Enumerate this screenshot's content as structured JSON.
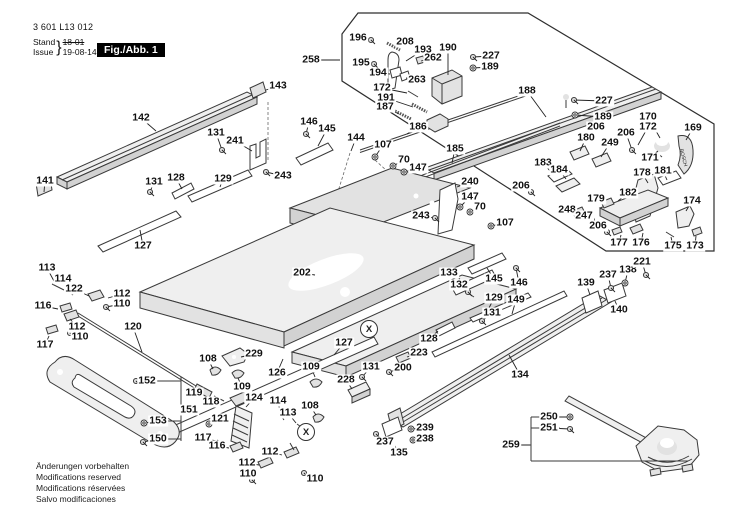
{
  "header": {
    "document_number": "3 601 L13 012",
    "revision_label_de": "Stand",
    "revision_label_en": "Issue",
    "revision_old": "18-01",
    "revision_new": "19-08-14",
    "figure_label": "Fig./Abb. 1"
  },
  "footer": {
    "lines": [
      "Änderungen vorbehalten",
      "Modifications reserved",
      "Modifications réservées",
      "Salvo modificaciones"
    ]
  },
  "diagram": {
    "brand": "BOSCH",
    "connector_symbol": "X",
    "connectors": [
      {
        "x": 369,
        "y": 329
      },
      {
        "x": 306,
        "y": 432
      }
    ],
    "labels": [
      {
        "t": "141",
        "x": 45,
        "y": 181,
        "lx": 44,
        "ly": 192
      },
      {
        "t": "142",
        "x": 141,
        "y": 118,
        "lx": 156,
        "ly": 131
      },
      {
        "t": "143",
        "x": 278,
        "y": 86,
        "lx": 266,
        "ly": 90
      },
      {
        "t": "131",
        "x": 216,
        "y": 133,
        "lx": 222,
        "ly": 150,
        "g": "screw"
      },
      {
        "t": "241",
        "x": 235,
        "y": 141,
        "lx": 252,
        "ly": 151
      },
      {
        "t": "131",
        "x": 154,
        "y": 182,
        "lx": 150,
        "ly": 192,
        "g": "screw"
      },
      {
        "t": "128",
        "x": 176,
        "y": 178,
        "lx": 182,
        "ly": 189
      },
      {
        "t": "129",
        "x": 223,
        "y": 179,
        "lx": 220,
        "ly": 187
      },
      {
        "t": "127",
        "x": 143,
        "y": 246,
        "lx": 140,
        "ly": 230
      },
      {
        "t": "243",
        "x": 283,
        "y": 176,
        "lx": 266,
        "ly": 172,
        "g": "screw"
      },
      {
        "t": "146",
        "x": 309,
        "y": 122,
        "lx": 306,
        "ly": 134,
        "g": "screw"
      },
      {
        "t": "145",
        "x": 327,
        "y": 129,
        "lx": 318,
        "ly": 146
      },
      {
        "t": "144",
        "x": 356,
        "y": 138,
        "lx": 351,
        "ly": 151
      },
      {
        "t": "107",
        "x": 383,
        "y": 145,
        "lx": 375,
        "ly": 157,
        "g": "washer"
      },
      {
        "t": "70",
        "x": 404,
        "y": 160,
        "lx": 393,
        "ly": 166,
        "g": "washer"
      },
      {
        "t": "147",
        "x": 418,
        "y": 168,
        "lx": 404,
        "ly": 172,
        "g": "washer"
      },
      {
        "t": "258",
        "x": 311,
        "y": 60,
        "lx": 340,
        "ly": 60
      },
      {
        "t": "196",
        "x": 358,
        "y": 38,
        "lx": 371,
        "ly": 40,
        "g": "screw"
      },
      {
        "t": "208",
        "x": 405,
        "y": 42,
        "lx": 395,
        "ly": 47
      },
      {
        "t": "193",
        "x": 423,
        "y": 50,
        "lx": 406,
        "ly": 61
      },
      {
        "t": "190",
        "x": 448,
        "y": 48,
        "lx": 448,
        "ly": 75
      },
      {
        "t": "227",
        "x": 491,
        "y": 56,
        "lx": 473,
        "ly": 57,
        "g": "screw"
      },
      {
        "t": "189",
        "x": 490,
        "y": 67,
        "lx": 473,
        "ly": 68,
        "g": "washer"
      },
      {
        "t": "195",
        "x": 361,
        "y": 63,
        "lx": 374,
        "ly": 64,
        "g": "screw"
      },
      {
        "t": "262",
        "x": 433,
        "y": 58,
        "lx": 421,
        "ly": 61
      },
      {
        "t": "194",
        "x": 378,
        "y": 73,
        "lx": 390,
        "ly": 74
      },
      {
        "t": "263",
        "x": 417,
        "y": 80,
        "lx": 406,
        "ly": 78
      },
      {
        "t": "172",
        "x": 382,
        "y": 88,
        "lx": 407,
        "ly": 93
      },
      {
        "t": "191",
        "x": 386,
        "y": 98,
        "lx": 413,
        "ly": 107
      },
      {
        "t": "187",
        "x": 385,
        "y": 107,
        "lx": 399,
        "ly": 114
      },
      {
        "t": "186",
        "x": 418,
        "y": 127,
        "lx": 407,
        "ly": 134
      },
      {
        "t": "188",
        "x": 527,
        "y": 91,
        "lx": 546,
        "ly": 117
      },
      {
        "t": "185",
        "x": 455,
        "y": 149,
        "lx": 452,
        "ly": 163
      },
      {
        "t": "227",
        "x": 604,
        "y": 101,
        "lx": 574,
        "ly": 100,
        "g": "screw"
      },
      {
        "t": "189",
        "x": 603,
        "y": 117,
        "lx": 575,
        "ly": 115,
        "g": "washer"
      },
      {
        "t": "206",
        "x": 596,
        "y": 127,
        "lx": 589,
        "ly": 139,
        "g": "screw"
      },
      {
        "t": "180",
        "x": 586,
        "y": 138,
        "lx": 580,
        "ly": 151
      },
      {
        "t": "249",
        "x": 610,
        "y": 143,
        "lx": 601,
        "ly": 157
      },
      {
        "t": "206",
        "x": 626,
        "y": 133,
        "lx": 632,
        "ly": 150,
        "g": "screw"
      },
      {
        "t": "170",
        "x": 648,
        "y": 117,
        "lx": 660,
        "ly": 138
      },
      {
        "t": "172",
        "x": 648,
        "y": 127,
        "lx": 638,
        "ly": 145
      },
      {
        "t": "169",
        "x": 693,
        "y": 128,
        "lx": 686,
        "ly": 140
      },
      {
        "t": "171",
        "x": 650,
        "y": 158,
        "lx": 658,
        "ly": 151
      },
      {
        "t": "178",
        "x": 642,
        "y": 173,
        "lx": 648,
        "ly": 183
      },
      {
        "t": "181",
        "x": 663,
        "y": 171,
        "lx": 667,
        "ly": 180
      },
      {
        "t": "183",
        "x": 543,
        "y": 163,
        "lx": 551,
        "ly": 172
      },
      {
        "t": "184",
        "x": 559,
        "y": 170,
        "lx": 566,
        "ly": 179
      },
      {
        "t": "182",
        "x": 628,
        "y": 193,
        "lx": 618,
        "ly": 201
      },
      {
        "t": "179",
        "x": 596,
        "y": 199,
        "lx": 605,
        "ly": 204
      },
      {
        "t": "248",
        "x": 567,
        "y": 210,
        "lx": 576,
        "ly": 212
      },
      {
        "t": "247",
        "x": 584,
        "y": 216,
        "lx": 592,
        "ly": 220,
        "g": "screw"
      },
      {
        "t": "206",
        "x": 598,
        "y": 226,
        "lx": 607,
        "ly": 232,
        "g": "screw"
      },
      {
        "t": "174",
        "x": 692,
        "y": 201,
        "lx": 686,
        "ly": 211
      },
      {
        "t": "177",
        "x": 619,
        "y": 243,
        "lx": 621,
        "ly": 235
      },
      {
        "t": "176",
        "x": 641,
        "y": 243,
        "lx": 643,
        "ly": 233
      },
      {
        "t": "175",
        "x": 673,
        "y": 246,
        "lx": 671,
        "ly": 237
      },
      {
        "t": "173",
        "x": 695,
        "y": 246,
        "lx": 696,
        "ly": 236
      },
      {
        "t": "240",
        "x": 470,
        "y": 182,
        "lx": 457,
        "ly": 187
      },
      {
        "t": "206",
        "x": 521,
        "y": 186,
        "lx": 531,
        "ly": 192,
        "g": "screw"
      },
      {
        "t": "147",
        "x": 470,
        "y": 197,
        "lx": 460,
        "ly": 207,
        "g": "washer"
      },
      {
        "t": "70",
        "x": 480,
        "y": 207,
        "lx": 470,
        "ly": 212,
        "g": "washer"
      },
      {
        "t": "243",
        "x": 421,
        "y": 216,
        "lx": 435,
        "ly": 218,
        "g": "screw"
      },
      {
        "t": "107",
        "x": 505,
        "y": 223,
        "lx": 491,
        "ly": 226,
        "g": "washer"
      },
      {
        "t": "202",
        "x": 302,
        "y": 273,
        "lx": 315,
        "ly": 275
      },
      {
        "t": "113",
        "x": 47,
        "y": 268,
        "lx": 55,
        "ly": 283
      },
      {
        "t": "114",
        "x": 63,
        "y": 279,
        "lx": 68,
        "ly": 290
      },
      {
        "t": "122",
        "x": 74,
        "y": 289,
        "lx": 89,
        "ly": 296
      },
      {
        "t": "112",
        "x": 122,
        "y": 294,
        "lx": 108,
        "ly": 298
      },
      {
        "t": "110",
        "x": 122,
        "y": 304,
        "lx": 106,
        "ly": 307,
        "g": "screw"
      },
      {
        "t": "116",
        "x": 43,
        "y": 306,
        "lx": 58,
        "ly": 309
      },
      {
        "t": "112",
        "x": 77,
        "y": 327,
        "lx": 70,
        "ly": 319
      },
      {
        "t": "110",
        "x": 80,
        "y": 337,
        "lx": 70,
        "ly": 333,
        "g": "screw"
      },
      {
        "t": "117",
        "x": 45,
        "y": 345,
        "lx": 49,
        "ly": 336
      },
      {
        "t": "120",
        "x": 133,
        "y": 327,
        "lx": 142,
        "ly": 352
      },
      {
        "t": "152",
        "x": 147,
        "y": 381,
        "lx": 136,
        "ly": 381,
        "g": "screw"
      },
      {
        "t": "151",
        "x": 189,
        "y": 410,
        "lx": 182,
        "ly": 410
      },
      {
        "t": "153",
        "x": 158,
        "y": 421,
        "lx": 144,
        "ly": 423,
        "g": "washer"
      },
      {
        "t": "150",
        "x": 158,
        "y": 439,
        "lx": 143,
        "ly": 442,
        "g": "screw"
      },
      {
        "t": "119",
        "x": 194,
        "y": 393,
        "lx": 201,
        "ly": 389
      },
      {
        "t": "118",
        "x": 211,
        "y": 402,
        "lx": 216,
        "ly": 398
      },
      {
        "t": "121",
        "x": 220,
        "y": 419,
        "lx": 209,
        "ly": 424,
        "g": "washer"
      },
      {
        "t": "108",
        "x": 208,
        "y": 359,
        "lx": 213,
        "ly": 369
      },
      {
        "t": "229",
        "x": 254,
        "y": 354,
        "lx": 241,
        "ly": 357
      },
      {
        "t": "126",
        "x": 277,
        "y": 373,
        "lx": 283,
        "ly": 359
      },
      {
        "t": "109",
        "x": 242,
        "y": 387,
        "lx": 238,
        "ly": 378
      },
      {
        "t": "124",
        "x": 254,
        "y": 398,
        "lx": 246,
        "ly": 407
      },
      {
        "t": "114",
        "x": 278,
        "y": 401,
        "lx": 280,
        "ly": 412
      },
      {
        "t": "113",
        "x": 288,
        "y": 413,
        "lx": 296,
        "ly": 423
      },
      {
        "t": "117",
        "x": 203,
        "y": 438,
        "lx": 216,
        "ly": 441
      },
      {
        "t": "116",
        "x": 217,
        "y": 446,
        "lx": 229,
        "ly": 448
      },
      {
        "t": "112",
        "x": 270,
        "y": 452,
        "lx": 282,
        "ly": 455
      },
      {
        "t": "112",
        "x": 247,
        "y": 463,
        "lx": 259,
        "ly": 465
      },
      {
        "t": "110",
        "x": 248,
        "y": 474,
        "lx": 252,
        "ly": 480,
        "g": "screw"
      },
      {
        "t": "110",
        "x": 315,
        "y": 479,
        "lx": 304,
        "ly": 473,
        "g": "screw"
      },
      {
        "t": "127",
        "x": 344,
        "y": 343,
        "lx": 334,
        "ly": 355
      },
      {
        "t": "109",
        "x": 311,
        "y": 367,
        "lx": 315,
        "ly": 377
      },
      {
        "t": "131",
        "x": 371,
        "y": 367,
        "lx": 362,
        "ly": 377,
        "g": "screw"
      },
      {
        "t": "228",
        "x": 346,
        "y": 380,
        "lx": 352,
        "ly": 389
      },
      {
        "t": "108",
        "x": 310,
        "y": 406,
        "lx": 316,
        "ly": 415
      },
      {
        "t": "200",
        "x": 403,
        "y": 368,
        "lx": 389,
        "ly": 372,
        "g": "screw"
      },
      {
        "t": "223",
        "x": 419,
        "y": 353,
        "lx": 407,
        "ly": 357
      },
      {
        "t": "237",
        "x": 385,
        "y": 442,
        "lx": 376,
        "ly": 434,
        "g": "screw"
      },
      {
        "t": "135",
        "x": 399,
        "y": 453,
        "lx": 393,
        "ly": 443
      },
      {
        "t": "238",
        "x": 425,
        "y": 439,
        "lx": 413,
        "ly": 440,
        "g": "washer"
      },
      {
        "t": "239",
        "x": 425,
        "y": 428,
        "lx": 411,
        "ly": 429,
        "g": "washer"
      },
      {
        "t": "133",
        "x": 449,
        "y": 273,
        "lx": 460,
        "ly": 279
      },
      {
        "t": "132",
        "x": 459,
        "y": 285,
        "lx": 468,
        "ly": 292,
        "g": "screw"
      },
      {
        "t": "145",
        "x": 494,
        "y": 279,
        "lx": 487,
        "ly": 268
      },
      {
        "t": "146",
        "x": 519,
        "y": 283,
        "lx": 516,
        "ly": 268,
        "g": "screw"
      },
      {
        "t": "129",
        "x": 494,
        "y": 298,
        "lx": 488,
        "ly": 310
      },
      {
        "t": "149",
        "x": 516,
        "y": 300,
        "lx": 512,
        "ly": 314
      },
      {
        "t": "131",
        "x": 492,
        "y": 313,
        "lx": 482,
        "ly": 321,
        "g": "screw"
      },
      {
        "t": "128",
        "x": 429,
        "y": 339,
        "lx": 438,
        "ly": 331
      },
      {
        "t": "134",
        "x": 520,
        "y": 375,
        "lx": 509,
        "ly": 355
      },
      {
        "t": "139",
        "x": 586,
        "y": 283,
        "lx": 590,
        "ly": 295
      },
      {
        "t": "237",
        "x": 608,
        "y": 275,
        "lx": 611,
        "ly": 288,
        "g": "screw"
      },
      {
        "t": "138",
        "x": 628,
        "y": 270,
        "lx": 625,
        "ly": 283,
        "g": "washer"
      },
      {
        "t": "221",
        "x": 642,
        "y": 262,
        "lx": 646,
        "ly": 275,
        "g": "screw"
      },
      {
        "t": "140",
        "x": 619,
        "y": 310,
        "lx": 615,
        "ly": 301
      },
      {
        "t": "250",
        "x": 549,
        "y": 417,
        "lx": 570,
        "ly": 417,
        "g": "washer"
      },
      {
        "t": "251",
        "x": 549,
        "y": 428,
        "lx": 570,
        "ly": 429,
        "g": "screw"
      },
      {
        "t": "259",
        "x": 511,
        "y": 445,
        "lx": 530,
        "ly": 445
      }
    ]
  }
}
